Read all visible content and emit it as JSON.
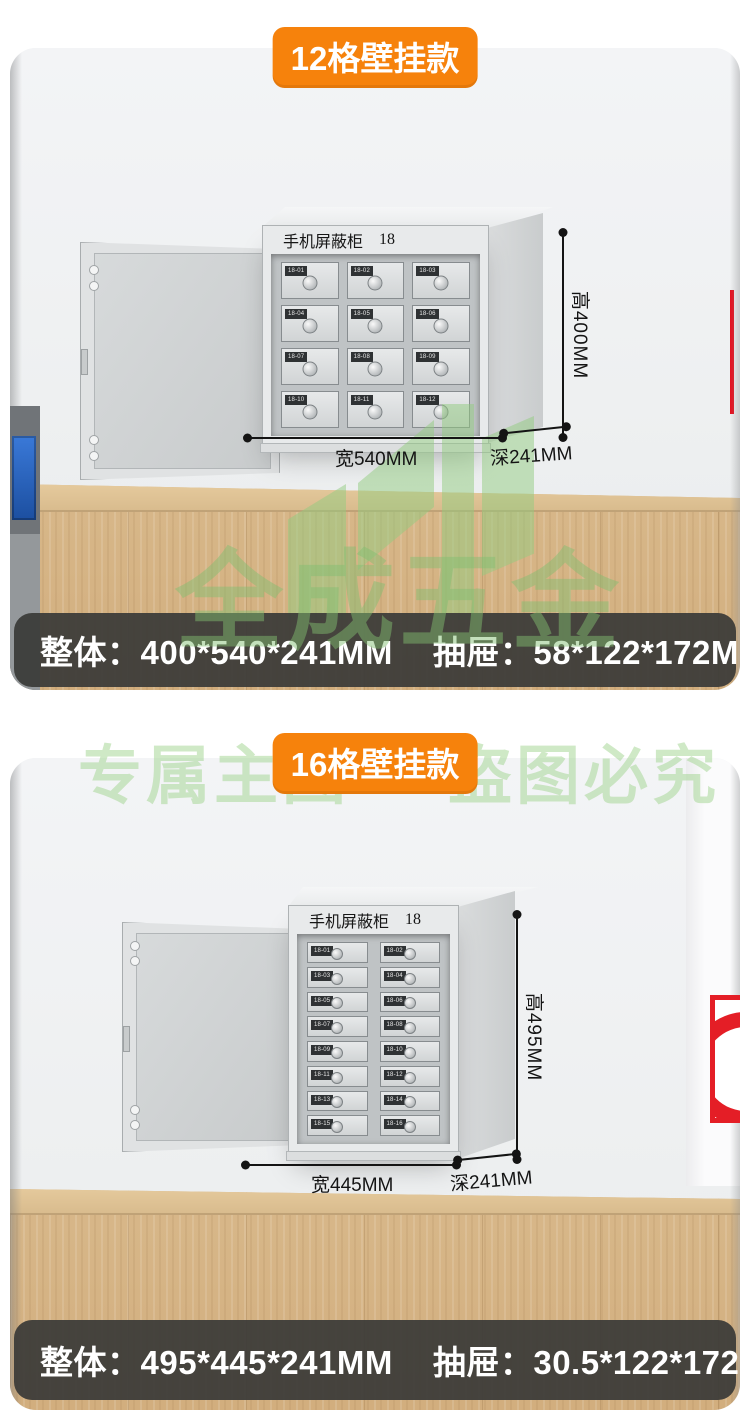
{
  "watermarks": {
    "tagline_left": "专属主图",
    "tagline_right": "盗图必究",
    "brand": "全成五金"
  },
  "sections": [
    {
      "badge": "12格壁挂款",
      "cabinet": {
        "title": "手机屏蔽柜",
        "number": "18",
        "grid": "3x4",
        "drawers": [
          "18-01",
          "18-02",
          "18-03",
          "18-04",
          "18-05",
          "18-06",
          "18-07",
          "18-08",
          "18-09",
          "18-10",
          "18-11",
          "18-12"
        ]
      },
      "dims": {
        "height": "高400MM",
        "width": "宽540MM",
        "depth": "深241MM"
      },
      "info": {
        "overall_label": "整体：",
        "overall_value": "400*540*241MM",
        "drawer_label": "抽屉：",
        "drawer_value": "58*122*172MM"
      }
    },
    {
      "badge": "16格壁挂款",
      "cabinet": {
        "title": "手机屏蔽柜",
        "number": "18",
        "grid": "2x8",
        "drawers": [
          "18-01",
          "18-02",
          "18-03",
          "18-04",
          "18-05",
          "18-06",
          "18-07",
          "18-08",
          "18-09",
          "18-10",
          "18-11",
          "18-12",
          "18-13",
          "18-14",
          "18-15",
          "18-16"
        ]
      },
      "dims": {
        "height": "高495MM",
        "width": "宽445MM",
        "depth": "深241MM"
      },
      "info": {
        "overall_label": "整体：",
        "overall_value": "495*445*241MM",
        "drawer_label": "抽屉：",
        "drawer_value": "30.5*122*172MM"
      }
    }
  ],
  "colors": {
    "badge_orange": "#f6820c",
    "spec_bar_bg": "#3a3a38",
    "watermark_green": "#9fd08c",
    "wood": "#d6b385",
    "alarm_red": "#e41e26",
    "dimension_line": "#141414"
  }
}
